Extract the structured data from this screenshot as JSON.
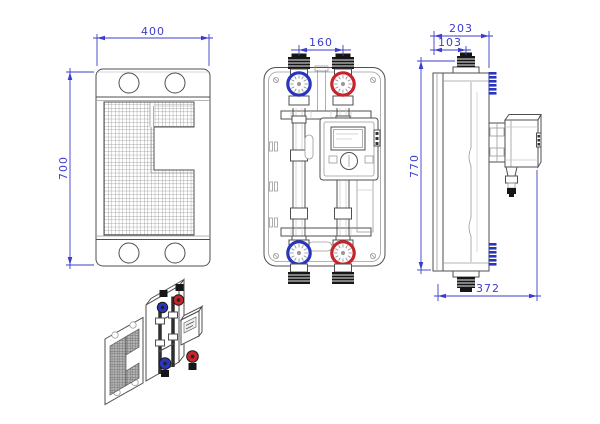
{
  "dimensions": {
    "hx_width_mm": "400",
    "hx_height_mm": "700",
    "valve_spacing_mm": "160",
    "depth_total_mm": "203",
    "depth_top_port_mm": "103",
    "overall_height_mm": "770",
    "depth_with_pump_mm": "372"
  },
  "colors": {
    "dim_color": "#3c3ccd",
    "valve_blue": "#2a35bd",
    "valve_red": "#c5252b",
    "line_dark": "#4f4f4f",
    "fitting_black": "#161616"
  }
}
